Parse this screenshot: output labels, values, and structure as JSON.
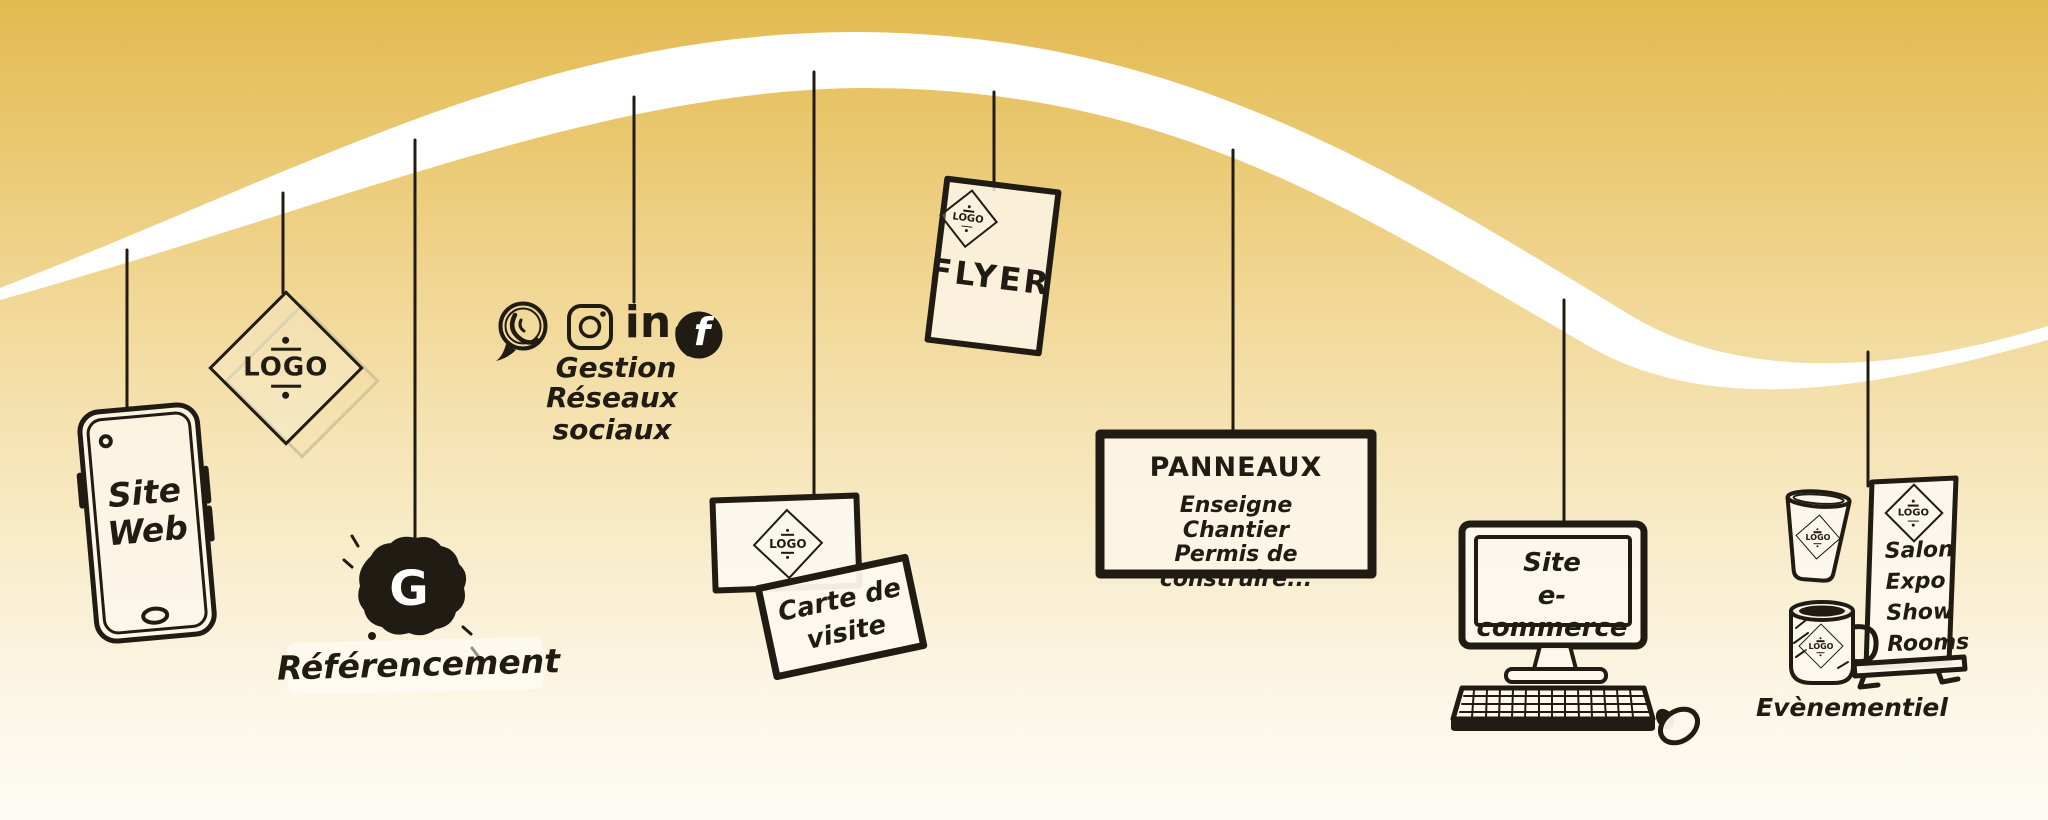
{
  "palette": {
    "ink": "#211c13",
    "wave": "#ffffff",
    "bg_top": "#e3ba50",
    "bg_mid": "#f1d795",
    "bg_bottom": "#fdfbf4",
    "shadow_tan": "#d3c69e"
  },
  "site_web": {
    "label": "Site\nWeb"
  },
  "logo_tag": {
    "label": "LOGO"
  },
  "referencement": {
    "google_initial": "G",
    "label": "Référencement"
  },
  "social": {
    "icons": [
      "whatsapp-icon",
      "instagram-icon",
      "linkedin-icon",
      "facebook-icon"
    ],
    "linkedin_label": "in",
    "facebook_label": "f",
    "line1": "Gestion",
    "line2": "Réseaux sociaux"
  },
  "carte_visite": {
    "logo": "LOGO",
    "label": "Carte de\nvisite"
  },
  "flyer": {
    "logo": "LOGO",
    "label": "FLYER"
  },
  "panneaux": {
    "title": "PANNEAUX",
    "lines": [
      "Enseigne",
      "Chantier",
      "Permis de construire..."
    ]
  },
  "ecommerce": {
    "label": "Site\ne-commerce"
  },
  "evenementiel": {
    "cup_logo": "LOGO",
    "mug_logo": "LOGO",
    "banner_logo": "LOGO",
    "banner_lines": [
      "Salon",
      "Expo",
      "Show",
      "Rooms"
    ],
    "label": "Evènementiel"
  }
}
